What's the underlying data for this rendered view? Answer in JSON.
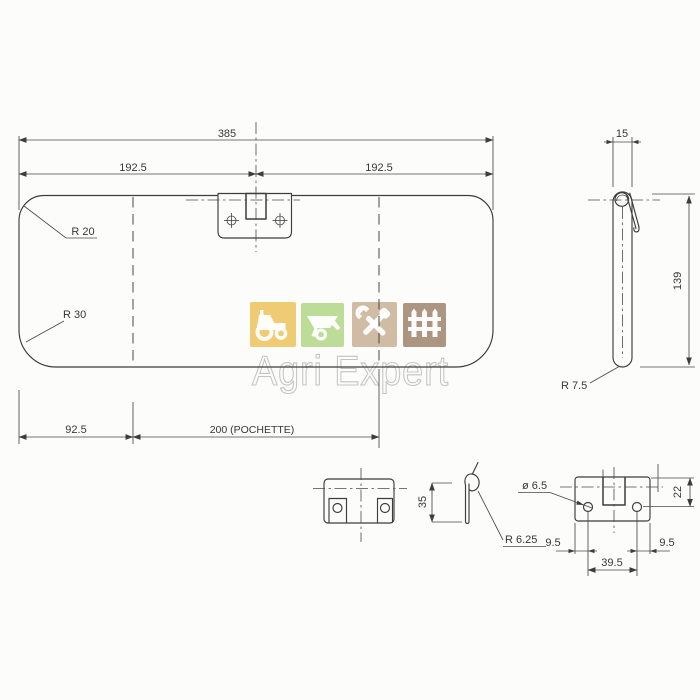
{
  "watermark": {
    "brand": "Agri Expert",
    "tiles": [
      {
        "icon": "tractor-icon",
        "color": "#edc765"
      },
      {
        "icon": "wheelbarrow-icon",
        "color": "#b6d88c"
      },
      {
        "icon": "tools-icon",
        "color": "#cbb59b"
      },
      {
        "icon": "fence-icon",
        "color": "#a38b73"
      }
    ]
  },
  "labels": {
    "overall_width": "385",
    "half_left": "192.5",
    "half_right": "192.5",
    "radius_top": "R 20",
    "radius_bottom": "R 30",
    "pocket_left": "92.5",
    "pocket_width": "200  (POCHETTE)",
    "thickness": "15",
    "side_height": "139",
    "radius_side": "R 7.5",
    "clip_height": "35",
    "clip_radius": "R 6.25",
    "hole_dia": "ø 6.5",
    "hole_depth": "22",
    "edge_hole_left": "9.5",
    "edge_hole_right": "9.5",
    "hole_spacing": "39.5"
  }
}
